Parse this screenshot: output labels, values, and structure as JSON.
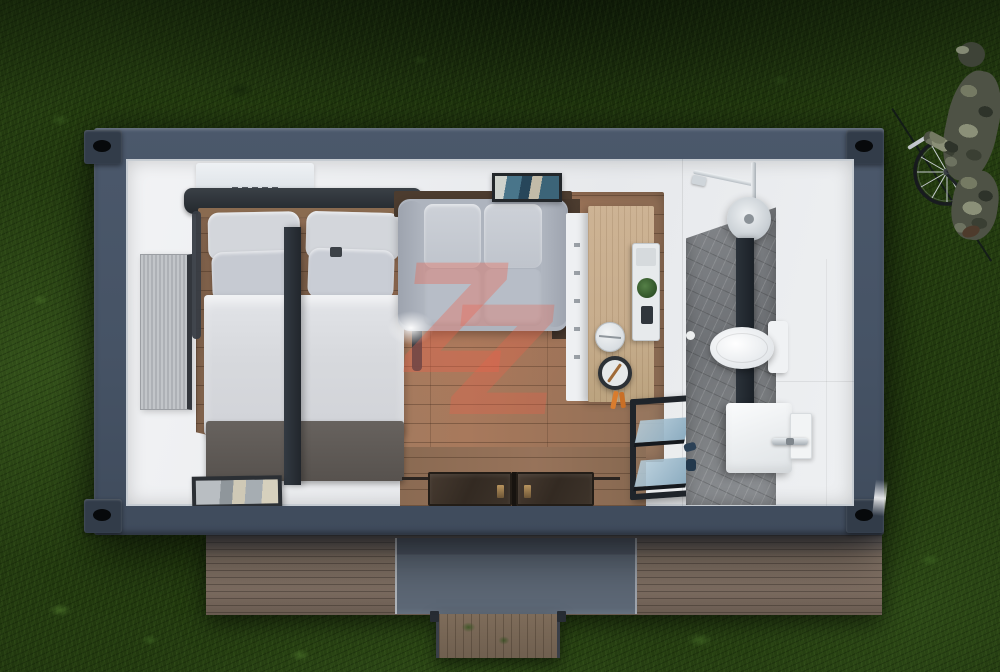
{
  "watermark": {
    "letter": "Z",
    "color": "#f06048",
    "style": "double-overlapping-translucent"
  },
  "scene": {
    "objects": [
      "lawn-grass-background",
      "shipping-container-tiny-home-top-cutaway-view",
      "double-bed-with-pillows-and-dark-blanket",
      "left-wall-window-blinds",
      "gray-two-seat-sofa",
      "wall-art-frame",
      "kitchenette-counter-with-pot-pan-and-plant-shelf",
      "glass-display-shelf-unit",
      "entry-sliding-glass-doors",
      "picture-frame-on-floor",
      "bathroom-with-shower-toilet-vanity-marble-tile",
      "wooden-deck-with-canopy-panel-and-steps",
      "person-in-camouflage-walking-bicycle"
    ]
  },
  "palette": {
    "grass_base": "#22390f",
    "frame": "#4b586b",
    "corner": "#323c49",
    "wood_floor": "#9a7962",
    "counter_wood": "#c7ad8d",
    "marble": "#6f7276",
    "bed_duvet": "#d7d9dd",
    "blanket": "#57524e",
    "headboard": "#23282d",
    "sofa": "#aeb4be",
    "beam": "#21262c",
    "deck_panel": "#5d6876",
    "door_glass": "#332a22",
    "glass_shelf": "#8cacc0",
    "chrome": "#aab1b7",
    "plant_green": "#2e5026",
    "utensil_orange": "#d97c2e"
  }
}
